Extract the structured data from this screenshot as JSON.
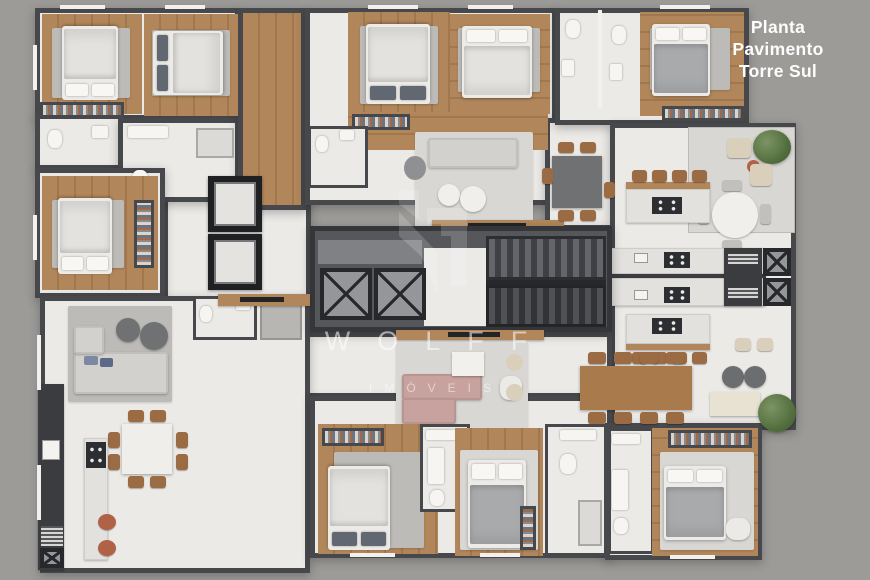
{
  "title": {
    "line1": "Planta",
    "line2": "Pavimento",
    "line3": "Torre Sul"
  },
  "watermark": {
    "brand": "WOLFF",
    "subtitle": "IMÓVEIS",
    "logo_icon": "wolff-monogram-icon"
  },
  "palette": {
    "background": "#9c9b98",
    "wall": "#46484c",
    "wall_dark": "#34363a",
    "floor": "#eceae7",
    "floor_balcony": "#d9d7d3",
    "wood": "#b1865a",
    "wood_dark": "#a1774e",
    "rug": "#bdbbb7",
    "bed_linen": "#edebe7",
    "sofa_gray": "#d2d1ce",
    "sofa_pink": "#c8a29e",
    "core": "#55575b",
    "terracotta": "#b06247",
    "table_dark": "#6f7173",
    "title_color": "#fdfdfd"
  }
}
